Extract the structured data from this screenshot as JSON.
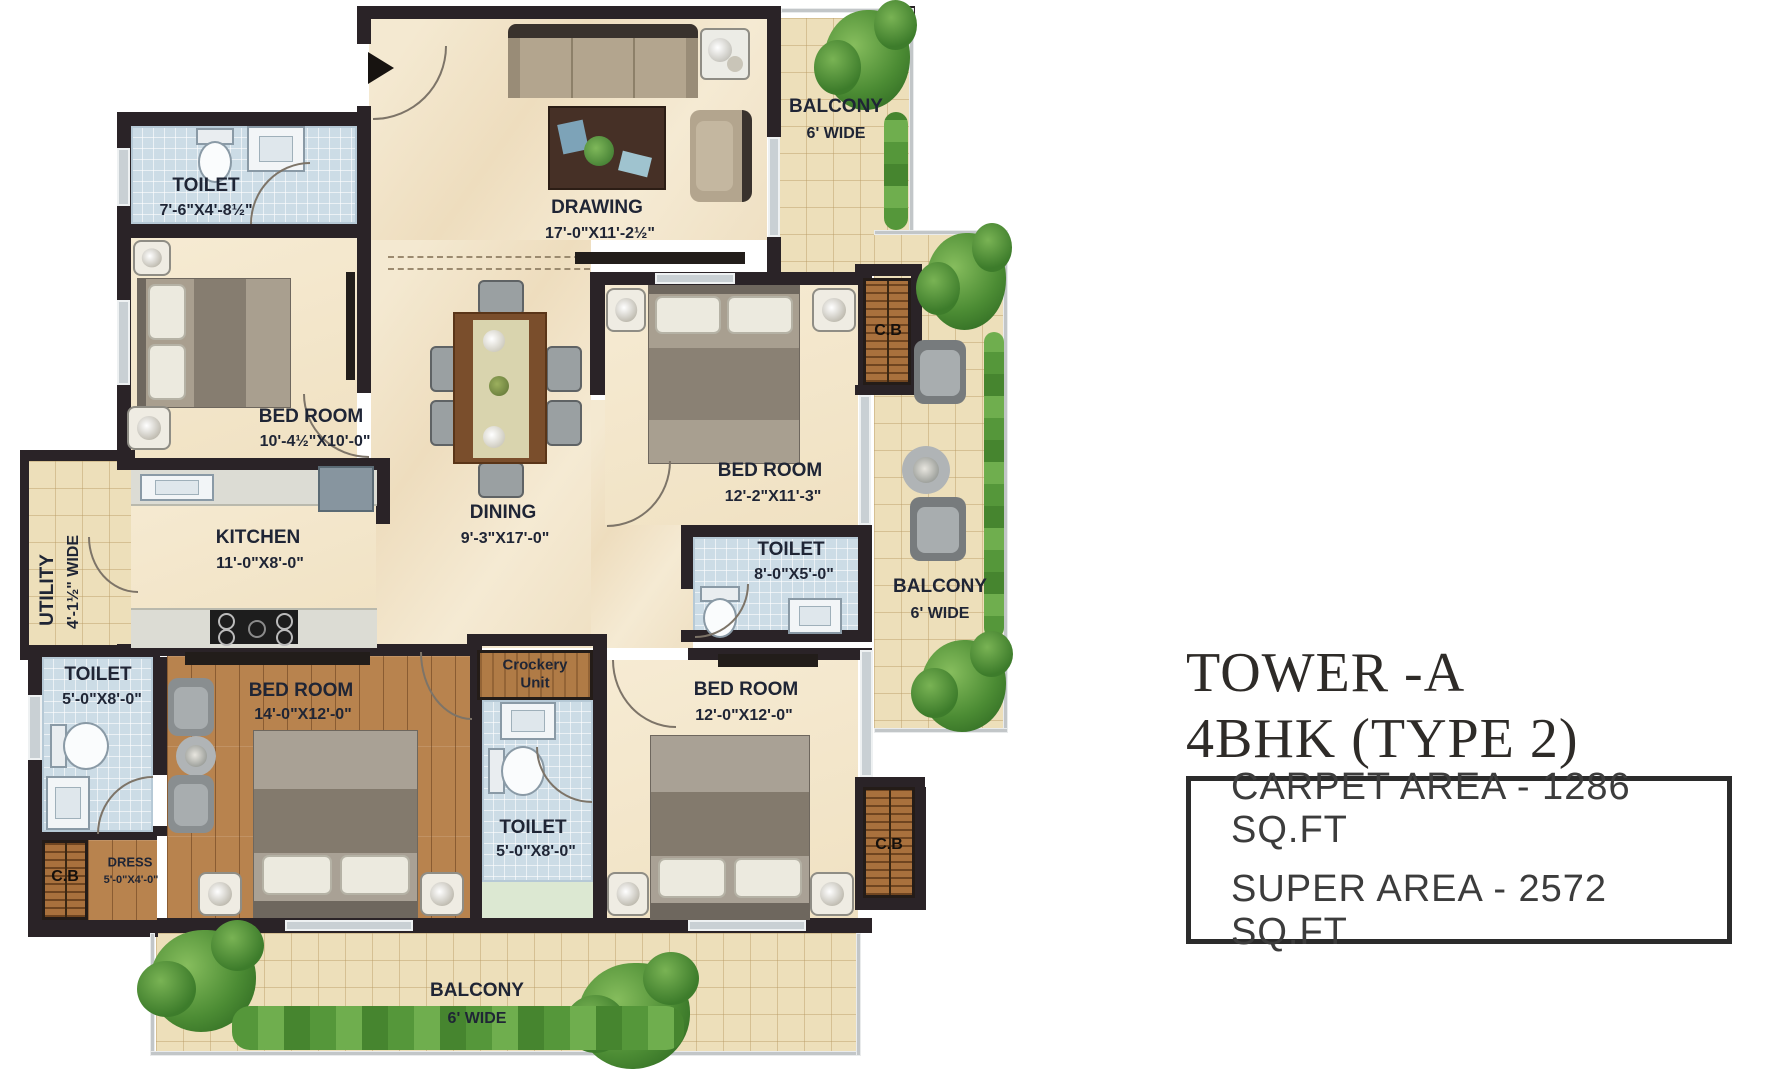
{
  "title": {
    "line1": "TOWER -A",
    "line2": "4BHK (TYPE 2)"
  },
  "info_box": {
    "carpet_area": "CARPET AREA - 1286 SQ.FT",
    "super_area": "SUPER AREA - 2572 SQ.FT"
  },
  "rooms": {
    "toilet_top_left": {
      "label": "TOILET",
      "dims": "7'-6\"X4'-8½\""
    },
    "bedroom_top_left": {
      "label": "BED ROOM",
      "dims": "10'-4½\"X10'-0\""
    },
    "drawing": {
      "label": "DRAWING",
      "dims": "17'-0\"X11'-2½\""
    },
    "balcony_top": {
      "label": "BALCONY",
      "dims": "6' WIDE"
    },
    "dining": {
      "label": "DINING",
      "dims": "9'-3\"X17'-0\""
    },
    "kitchen": {
      "label": "KITCHEN",
      "dims": "11'-0\"X8'-0\""
    },
    "utility": {
      "label": "UTILITY",
      "dims": "4'-1½\" WIDE"
    },
    "bedroom_mid_right": {
      "label": "BED ROOM",
      "dims": "12'-2\"X11'-3\""
    },
    "toilet_mid": {
      "label": "TOILET",
      "dims": "8'-0\"X5'-0\""
    },
    "balcony_right": {
      "label": "BALCONY",
      "dims": "6' WIDE"
    },
    "toilet_bottom_left": {
      "label": "TOILET",
      "dims": "5'-0\"X8'-0\""
    },
    "bedroom_master": {
      "label": "BED ROOM",
      "dims": "14'-0\"X12'-0\""
    },
    "crockery": {
      "label": "Crockery",
      "label2": "Unit"
    },
    "toilet_bottom_mid": {
      "label": "TOILET",
      "dims": "5'-0\"X8'-0\""
    },
    "bedroom_bottom_right": {
      "label": "BED ROOM",
      "dims": "12'-0\"X12'-0\""
    },
    "dress": {
      "label": "DRESS",
      "dims": "5'-0\"X4'-0\""
    },
    "balcony_bottom": {
      "label": "BALCONY",
      "dims": "6' WIDE"
    },
    "cb_top": {
      "label": "C.B"
    },
    "cb_bottom_left": {
      "label": "C.B"
    },
    "cb_bottom_right": {
      "label": "C.B"
    }
  },
  "colors": {
    "wall": "#2a2327",
    "floor_cream": "#f3e6cc",
    "balcony_tile": "#eddfba",
    "toilet_tile": "#ccdce6",
    "wood_floor": "#b8834e",
    "cupboard_wood": "#a9713d",
    "plant_green": "#4c8c34",
    "label_text": "#1f2535"
  }
}
